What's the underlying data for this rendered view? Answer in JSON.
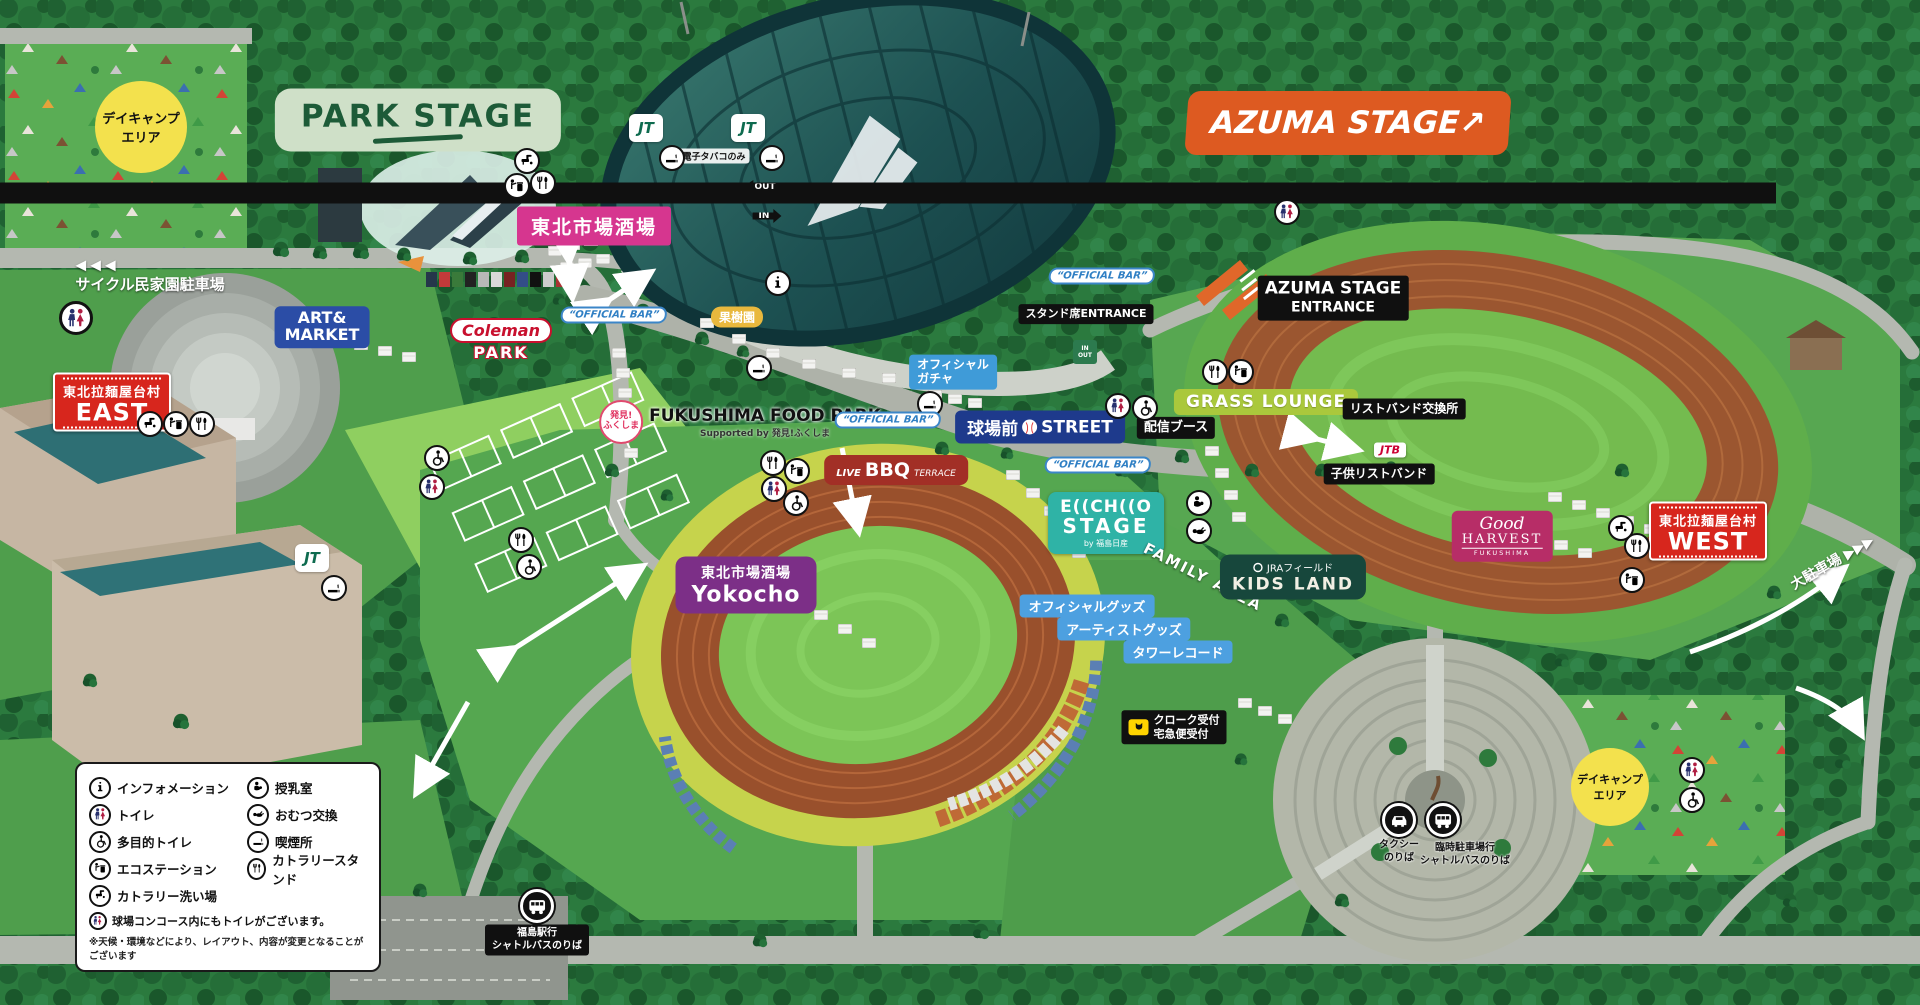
{
  "colors": {
    "forest_green": "#2b7a3e",
    "grass": "#55a750",
    "road_gray": "#b4b8b0",
    "azuma_orange": "#dd5a21",
    "park_stage_green": "#1d5b38",
    "echo_teal": "#2fb3a6",
    "market_pink": "#d6368f",
    "yokocho_purple": "#7c2f87",
    "village_red": "#d7261d",
    "art_blue": "#2b4da6",
    "kids_green": "#17473c",
    "grass_lounge_green": "#aac83c",
    "harvest_crimson": "#b72d67",
    "goods_blue": "#4da0e0",
    "track_brown": "#99502c",
    "lime_band": "#c6d34c"
  },
  "stages": {
    "park": {
      "label": "PARK STAGE"
    },
    "azuma": {
      "label": "AZUMA STAGE",
      "arrow": "↗"
    },
    "echo": {
      "name": "E((CH((O",
      "name2": "STAGE",
      "by": "by 福島日産"
    }
  },
  "stadium": {
    "entrance": {
      "line1": "AZUMA STAGE",
      "line2": "ENTRANCE"
    },
    "stand_entrance": "スタンド席ENTRANCE",
    "open_time": "12:00~",
    "gate_out": "OUT",
    "gate_in": "IN",
    "ecig": "電子タバコのみ",
    "jt": "JT",
    "street": {
      "left": "球場前",
      "right": "STREET"
    }
  },
  "areas": {
    "day_camp": {
      "line1": "デイキャンプ",
      "line2": "エリア"
    },
    "cycle_parking": {
      "arrows": "◀◀◀",
      "label": "サイクル民家園駐車場"
    },
    "large_parking": {
      "label": "大駐車場",
      "arrows": "▶▶▶"
    },
    "east_village": {
      "kanji": "東北拉麺屋台村",
      "en": "EAST"
    },
    "west_village": {
      "kanji": "東北拉麺屋台村",
      "en": "WEST"
    },
    "market_sakaba": "東北市場酒場",
    "yokocho": {
      "kanji": "東北市場酒場",
      "en": "Yokocho"
    },
    "art_market": {
      "line1": "ART&",
      "line2": "MARKET"
    },
    "coleman": {
      "brand": "Coleman",
      "sub": "PARK"
    },
    "orchard": "果樹園",
    "food_park": {
      "badge1": "発見!",
      "badge2": "ふくしま",
      "title": "FUKUSHIMA FOOD PARK",
      "subtitle": "Supported by 発見!ふくしま"
    },
    "bbq": {
      "pre": "LIVE",
      "main": "BBQ",
      "post": "TERRACE"
    },
    "family_area": "FAMILY AREA",
    "kids_land": {
      "brand": "JRAフィールド",
      "name": "KIDS LAND"
    },
    "grass_lounge": "GRASS LOUNGE",
    "harvest": {
      "script": "Good",
      "main": "HARVEST",
      "sub": "FUKUSHIMA"
    }
  },
  "booths": {
    "official_bar": "“OFFICIAL BAR”",
    "official_gacha": {
      "line1": "オフィシャル",
      "line2": "ガチャ"
    },
    "distribution": "配信ブース",
    "wristband_exchange": "リストバンド交換所",
    "kids_wristband": "子供リストバンド",
    "jtb": "JTB",
    "official_goods": "オフィシャルグッズ",
    "artist_goods": "アーティストグッズ",
    "tower_records": "タワーレコード",
    "cloak": {
      "line1": "クローク受付",
      "line2": "宅急便受付"
    }
  },
  "transport": {
    "taxi": {
      "line1": "タクシー",
      "line2": "のりば"
    },
    "shuttle_temp": {
      "line1": "臨時駐車場行",
      "line2": "シャトルバスのりば"
    },
    "shuttle_fukushima": {
      "line1": "福島駅行",
      "line2": "シャトルバスのりば"
    }
  },
  "legend": {
    "items": [
      {
        "icon": "info-icon",
        "label": "インフォメーション"
      },
      {
        "icon": "toilet-icon",
        "label": "トイレ"
      },
      {
        "icon": "accessible-toilet-icon",
        "label": "多目的トイレ"
      },
      {
        "icon": "eco-station-icon",
        "label": "エコステーション"
      },
      {
        "icon": "cutlery-wash-icon",
        "label": "カトラリー洗い場"
      },
      {
        "icon": "nursing-room-icon",
        "label": "授乳室"
      },
      {
        "icon": "diaper-change-icon",
        "label": "おむつ交換"
      },
      {
        "icon": "smoking-area-icon",
        "label": "喫煙所"
      },
      {
        "icon": "cutlery-stand-icon",
        "label": "カトラリースタンド"
      }
    ],
    "note_toilet": "球場コンコース内にもトイレがございます。",
    "note_disclaimer": "※天候・環境などにより、レイアウト、内容が変更となることがございます"
  }
}
